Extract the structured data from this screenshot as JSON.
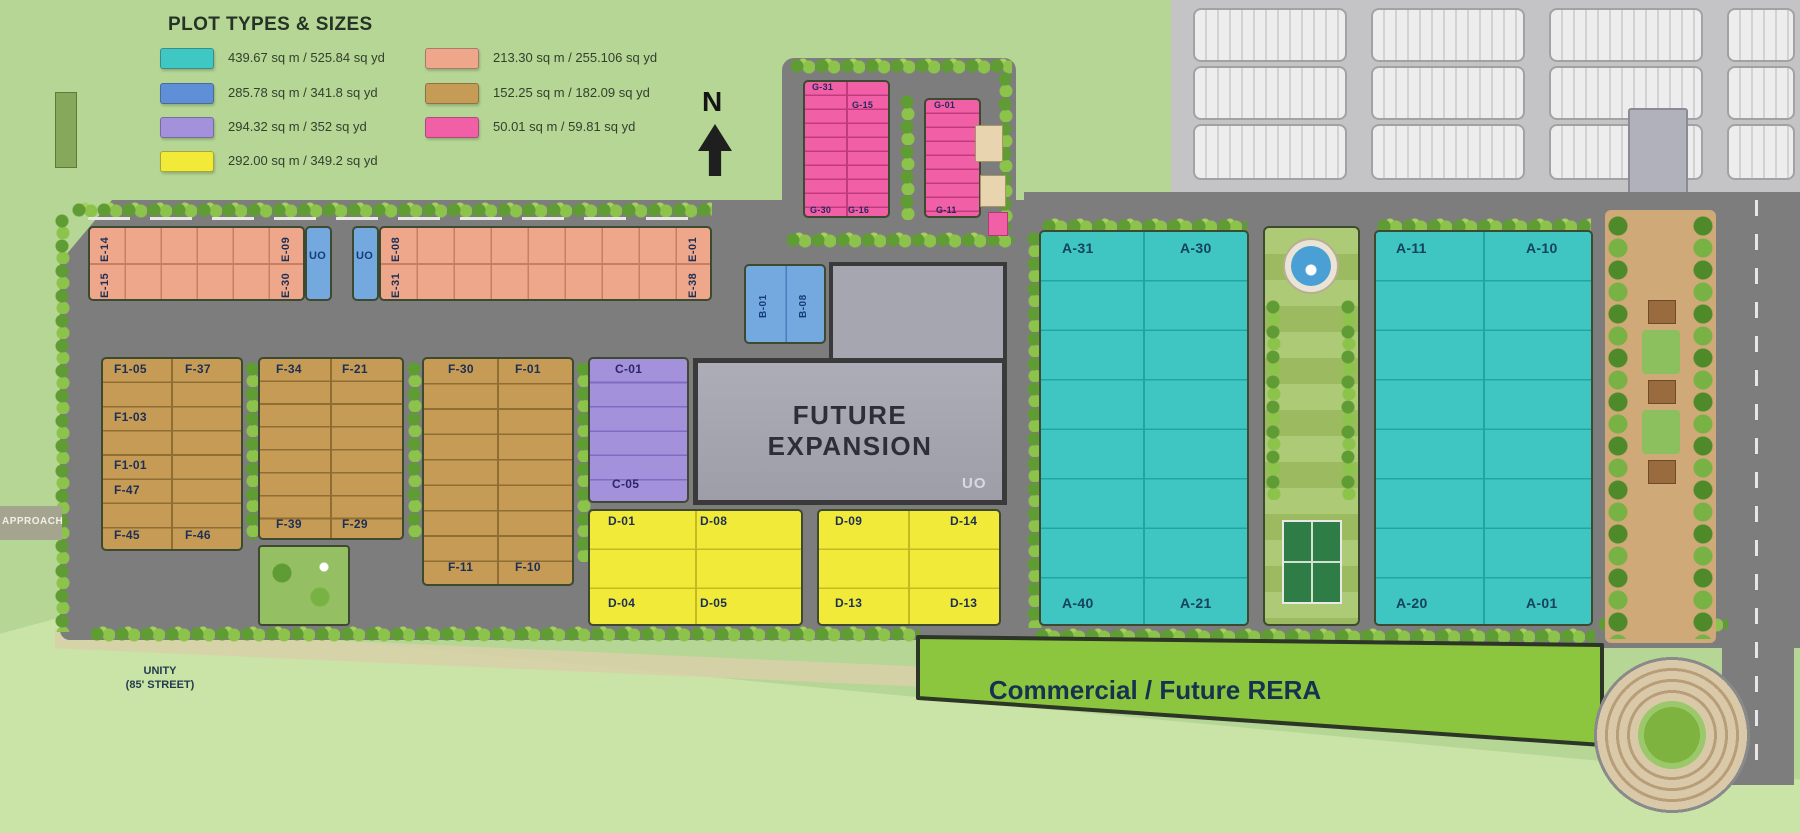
{
  "legend": {
    "title": "PLOT TYPES & SIZES",
    "items": [
      {
        "color": "#3fc7c3",
        "label": "439.67 sq m / 525.84 sq yd"
      },
      {
        "color": "#5f8fd6",
        "label": "285.78 sq m / 341.8 sq yd"
      },
      {
        "color": "#a391dc",
        "label": "294.32 sq m / 352 sq yd"
      },
      {
        "color": "#f2ea39",
        "label": "292.00 sq m / 349.2 sq yd"
      },
      {
        "color": "#efa78c",
        "label": "213.30 sq m / 255.106 sq yd"
      },
      {
        "color": "#c69b55",
        "label": "152.25 sq m / 182.09 sq yd"
      },
      {
        "color": "#f160a6",
        "label": "50.01 sq m / 59.81 sq yd"
      }
    ]
  },
  "compass": {
    "label": "N"
  },
  "notes": {
    "future_expansion": "FUTURE EXPANSION",
    "uo_small": "UO",
    "commercial": "Commercial / Future RERA",
    "approach": "APPROACH",
    "street_line1": "UNITY",
    "street_line2": "(85' STREET)"
  },
  "plots": {
    "e_top": [
      "E-14",
      "E-09",
      "E-08",
      "E-01"
    ],
    "e_bottom": [
      "E-15",
      "E-30",
      "E-31",
      "E-38"
    ],
    "uo": [
      "UO",
      "UO"
    ],
    "b": [
      "B-01",
      "B-08"
    ],
    "f1": [
      "F1-05",
      "F-37",
      "F1-03",
      "F1-01",
      "F-47",
      "F-45",
      "F-46"
    ],
    "f2": [
      "F-34",
      "F-21",
      "F-39",
      "F-29"
    ],
    "f3": [
      "F-30",
      "F-01",
      "F-11",
      "F-10"
    ],
    "c": [
      "C-01",
      "C-05"
    ],
    "d1": [
      "D-01",
      "D-08",
      "D-04",
      "D-05"
    ],
    "d2": [
      "D-09",
      "D-14",
      "D-13",
      "D-13"
    ],
    "a1": [
      "A-31",
      "A-30",
      "A-40",
      "A-21"
    ],
    "a2": [
      "A-11",
      "A-10",
      "A-20",
      "A-01"
    ],
    "g_top": [
      "G-31",
      "G-15",
      "G-01"
    ],
    "g_bottom": [
      "G-30",
      "G-16",
      "G-11"
    ]
  },
  "colors": {
    "background": "#b5d694",
    "road": "#7d7d7d",
    "future_expansion": "#a6a6b1",
    "commercial": "#8cc63f",
    "industrial": "#c4c4c6"
  }
}
